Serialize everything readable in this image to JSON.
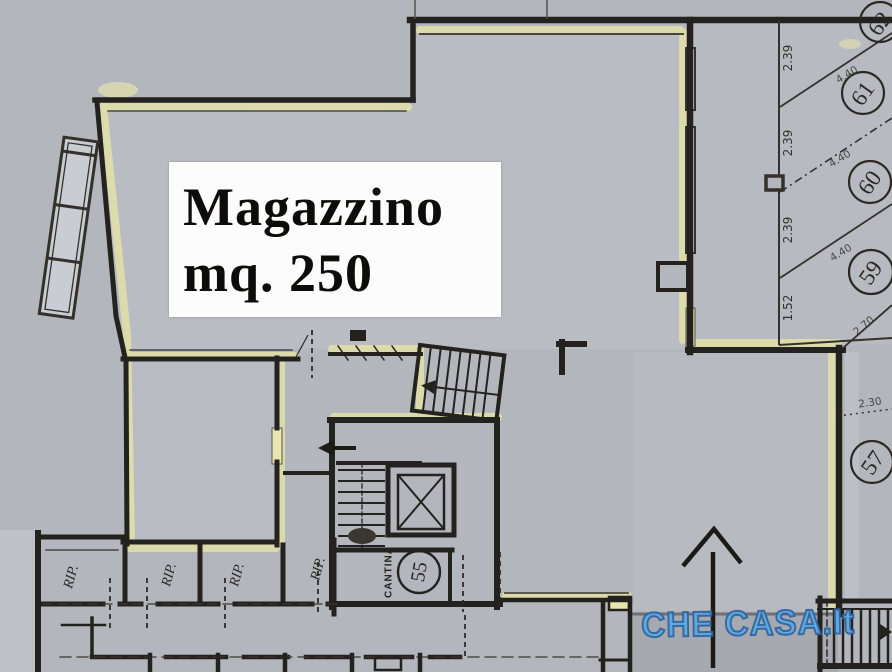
{
  "plan": {
    "unit_label": {
      "line1": "Magazzino",
      "line2": "mq. 250"
    },
    "rooms": {
      "cantina_label": "CANTINA",
      "cantina_number": "55",
      "storage_labels": [
        "RIP.",
        "RIP.",
        "RIP.",
        "RIP."
      ]
    },
    "parking": {
      "stalls": [
        {
          "number": "62"
        },
        {
          "number": "61"
        },
        {
          "number": "60"
        },
        {
          "number": "59"
        },
        {
          "number": "57"
        }
      ],
      "width_dims": [
        "2.39",
        "2.39",
        "2.39",
        "1.52"
      ],
      "length_dims": [
        "4.40",
        "4.40",
        "4.40"
      ],
      "other_dims": [
        "2.70",
        "2.30"
      ]
    },
    "watermark": "CHE CASA.It",
    "colors": {
      "paper": "#b3b6bd",
      "highlight_yellow": "#e6e3a6",
      "wall_black": "#24221f",
      "label_box_white": "#fcfcfc",
      "watermark_blue": "#5baae2",
      "watermark_outline": "#33659f"
    }
  }
}
